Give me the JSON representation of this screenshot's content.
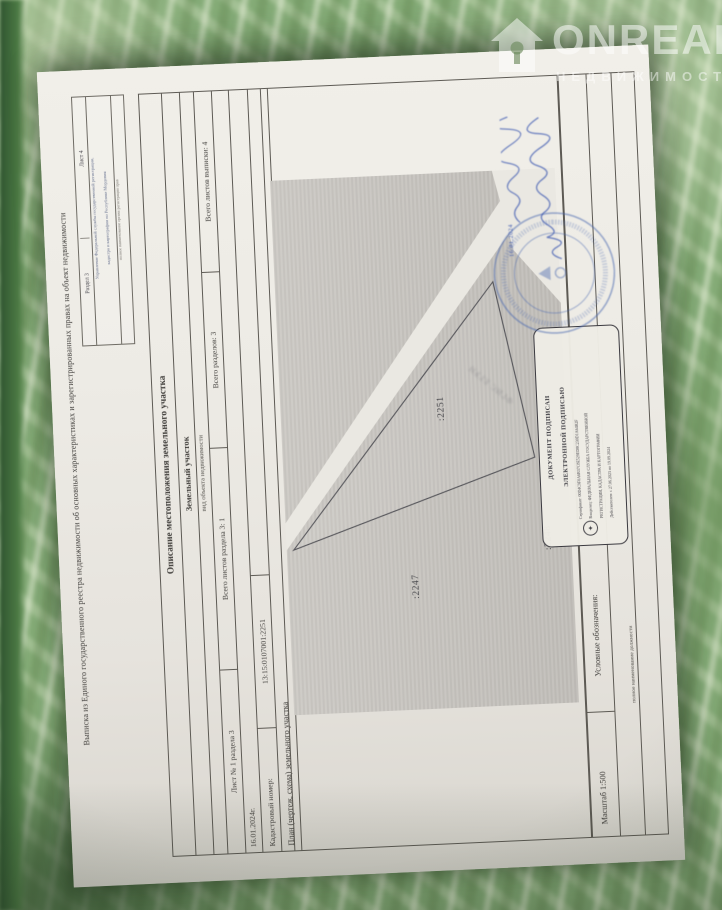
{
  "colors": {
    "carpet_green": "#84ab77",
    "paper": "#edebe5",
    "ink_blue": "#3b57b0",
    "stamp_blue": "#5b7cc0",
    "text": "#3f3d3a",
    "map_gray": "#c9c6c1"
  },
  "watermark": {
    "brand": "ONREALT",
    "subtitle": "НЕДВИЖИМОСТЬ"
  },
  "doc": {
    "corner": {
      "section": "Раздел 3",
      "sheet": "Лист 4",
      "org_line1": "Управление Федеральной службы государственной регистрации,",
      "org_line2": "кадастра и картографии по Республике Мордовия",
      "org_caption": "полное наименование органа регистрации прав"
    },
    "title": "Выписка из Единого государственного реестра недвижимости об основных характеристиках и зарегистрированных правах на объект недвижимости",
    "section_title": "Описание местоположения земельного участка",
    "object_kind": "Земельный участок",
    "object_kind_caption": "вид объекта недвижимости",
    "sheet_info": {
      "c1": "Лист № 1 раздела 3",
      "c2": "Всего листов раздела 3: 1",
      "c3": "Всего разделов: 3",
      "c4": "Всего листов выписки: 4"
    },
    "date": "16.01.2024г.",
    "cadastral": {
      "label": "Кадастровый номер:",
      "value": "13:15:0107001:2251"
    },
    "plan_title": "План (чертеж, схема) земельного участка",
    "plan": {
      "parcel_main": ":2251",
      "parcel_left": ":2247",
      "parcel_bottom": ":2248",
      "watermark_text": "ФГИС ЕГРН"
    },
    "scale": "Масштаб 1:500",
    "legend": "Условные обозначения:",
    "position_caption": "полное наименование должности",
    "sign_date": "16.01.2024",
    "esign": {
      "h1": "ДОКУМЕНТ ПОДПИСАН",
      "h2": "ЭЛЕКТРОННОЙ ПОДПИСЬЮ",
      "cert": "Сертификат: 00D4C9F0A6B37C8E529ED8C230D1A64B2F",
      "owner1": "Владелец: ФЕДЕРАЛЬНАЯ СЛУЖБА ГОСУДАРСТВЕННОЙ",
      "owner2": "РЕГИСТРАЦИИ, КАДАСТРА И КАРТОГРАФИИ",
      "valid": "Действителен: с 27.06.2023 по 19.09.2024"
    }
  }
}
